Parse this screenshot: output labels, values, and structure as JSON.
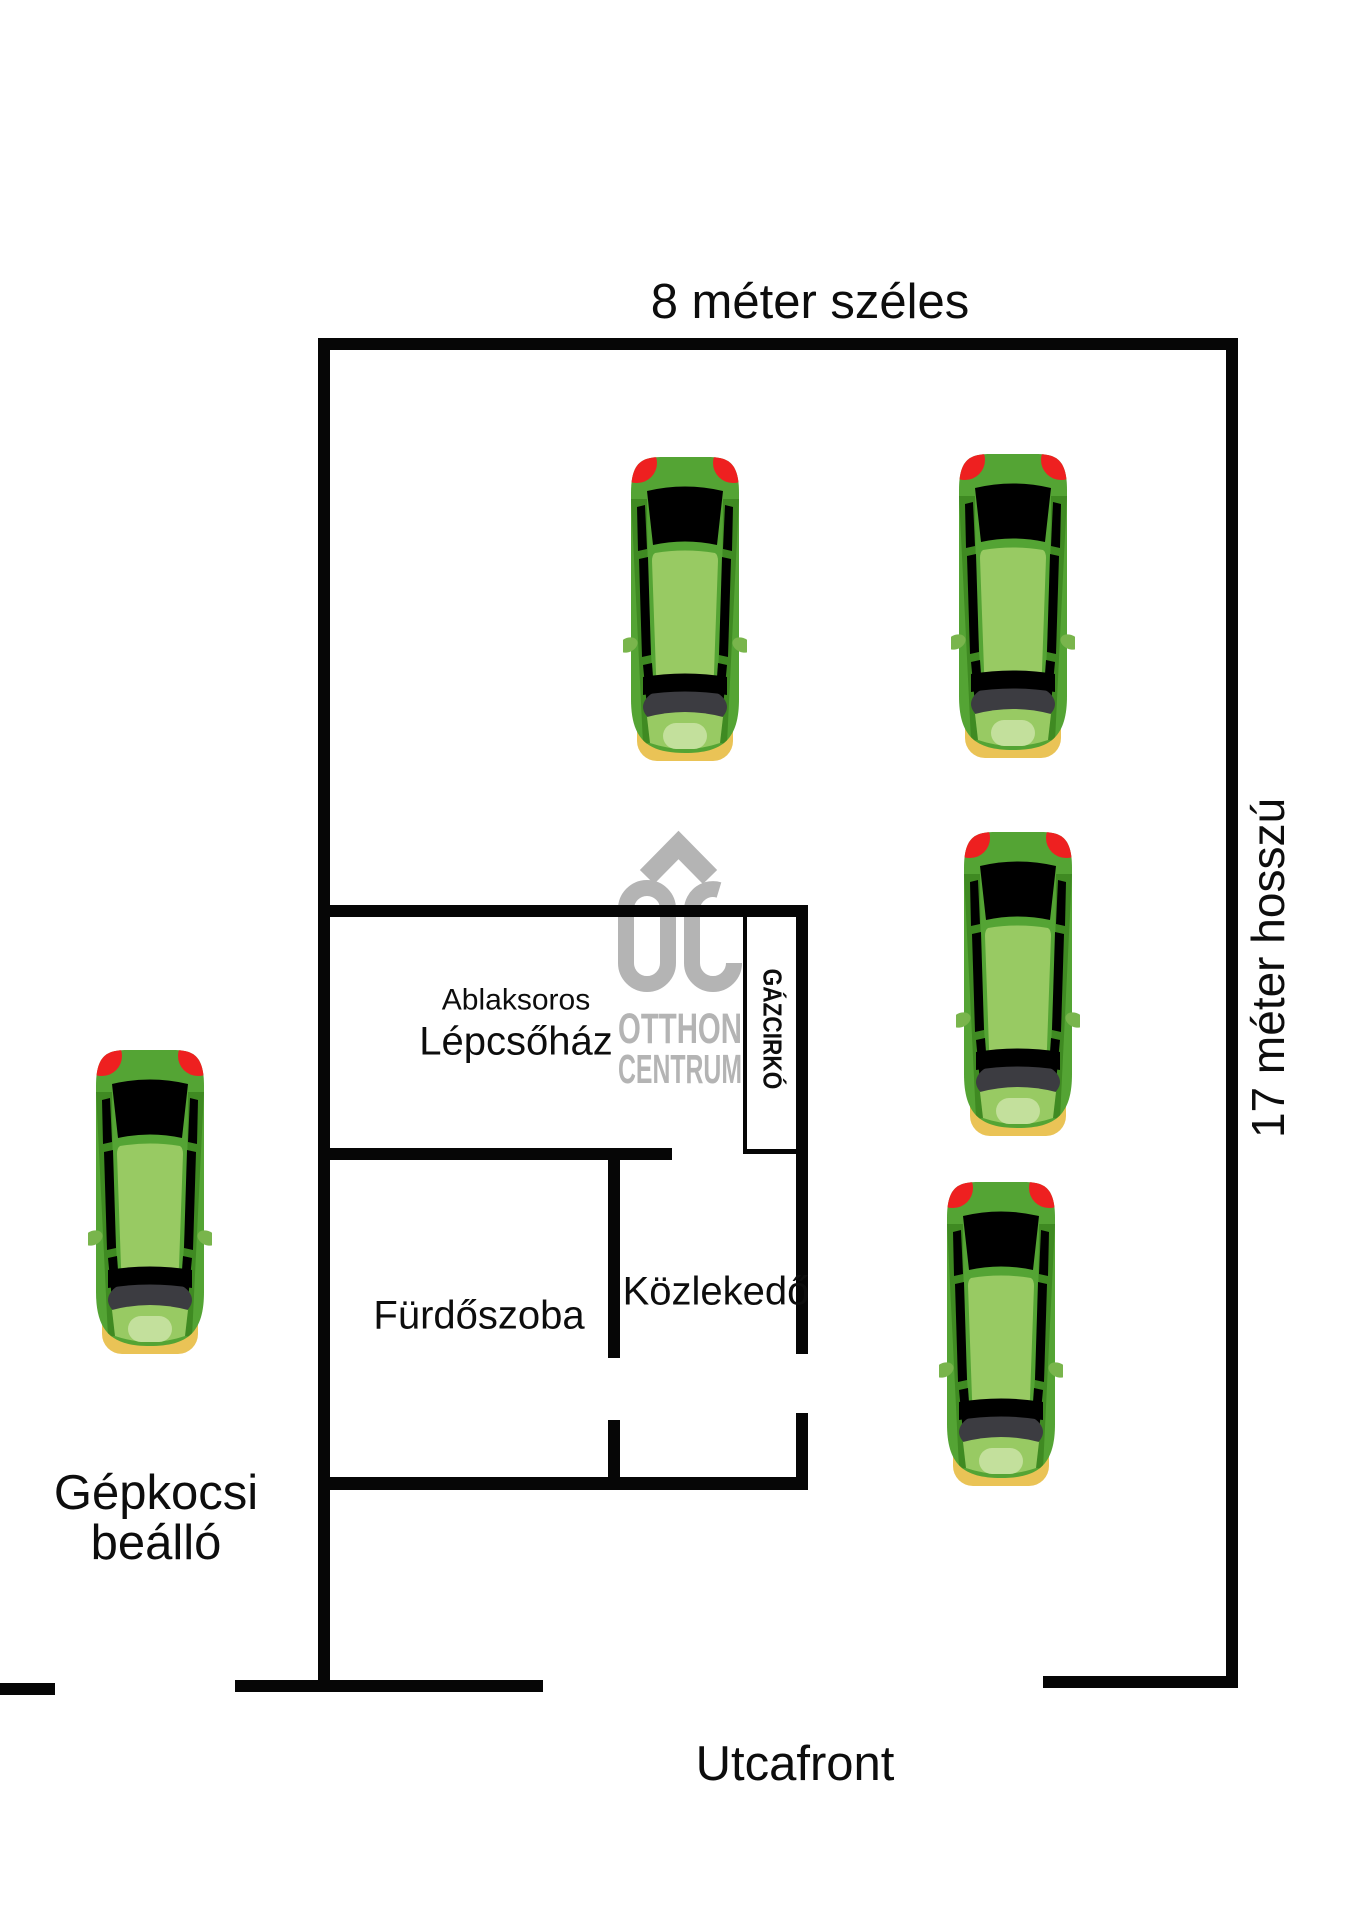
{
  "plan": {
    "labels": {
      "width_label": "8 méter széles",
      "length_label": "17 méter hosszú",
      "street_label": "Utcafront",
      "carport": [
        "Gépkocsi",
        "beálló"
      ],
      "stairwell": [
        "Ablaksoros",
        "Lépcsőház"
      ],
      "gas_heater": "GÁZCIRKÓ",
      "bathroom": "Fürdőszoba",
      "hallway": "Közlekedő"
    },
    "watermark": {
      "monogram": "OC",
      "name_line1": "OTTHON",
      "name_line2": "CENTRUM",
      "color": "#b4b4b4"
    },
    "colors": {
      "wall": "#060606",
      "text_color": "#0d0d0d",
      "car_body": "#54a434",
      "car_body_dark": "#3f8a22",
      "car_cabin": "#98ca63",
      "car_hood_highlight": "#c3e09c",
      "car_windshield": "#3c3c41",
      "car_taillight": "#ee2020",
      "car_bumper": "#eac356",
      "car_mirror": "#79b54c"
    },
    "car_size": {
      "w": 124,
      "h": 316
    },
    "cars": [
      {
        "x": 623,
        "y": 449
      },
      {
        "x": 951,
        "y": 446
      },
      {
        "x": 956,
        "y": 824
      },
      {
        "x": 939,
        "y": 1174
      },
      {
        "x": 88,
        "y": 1042
      }
    ]
  }
}
